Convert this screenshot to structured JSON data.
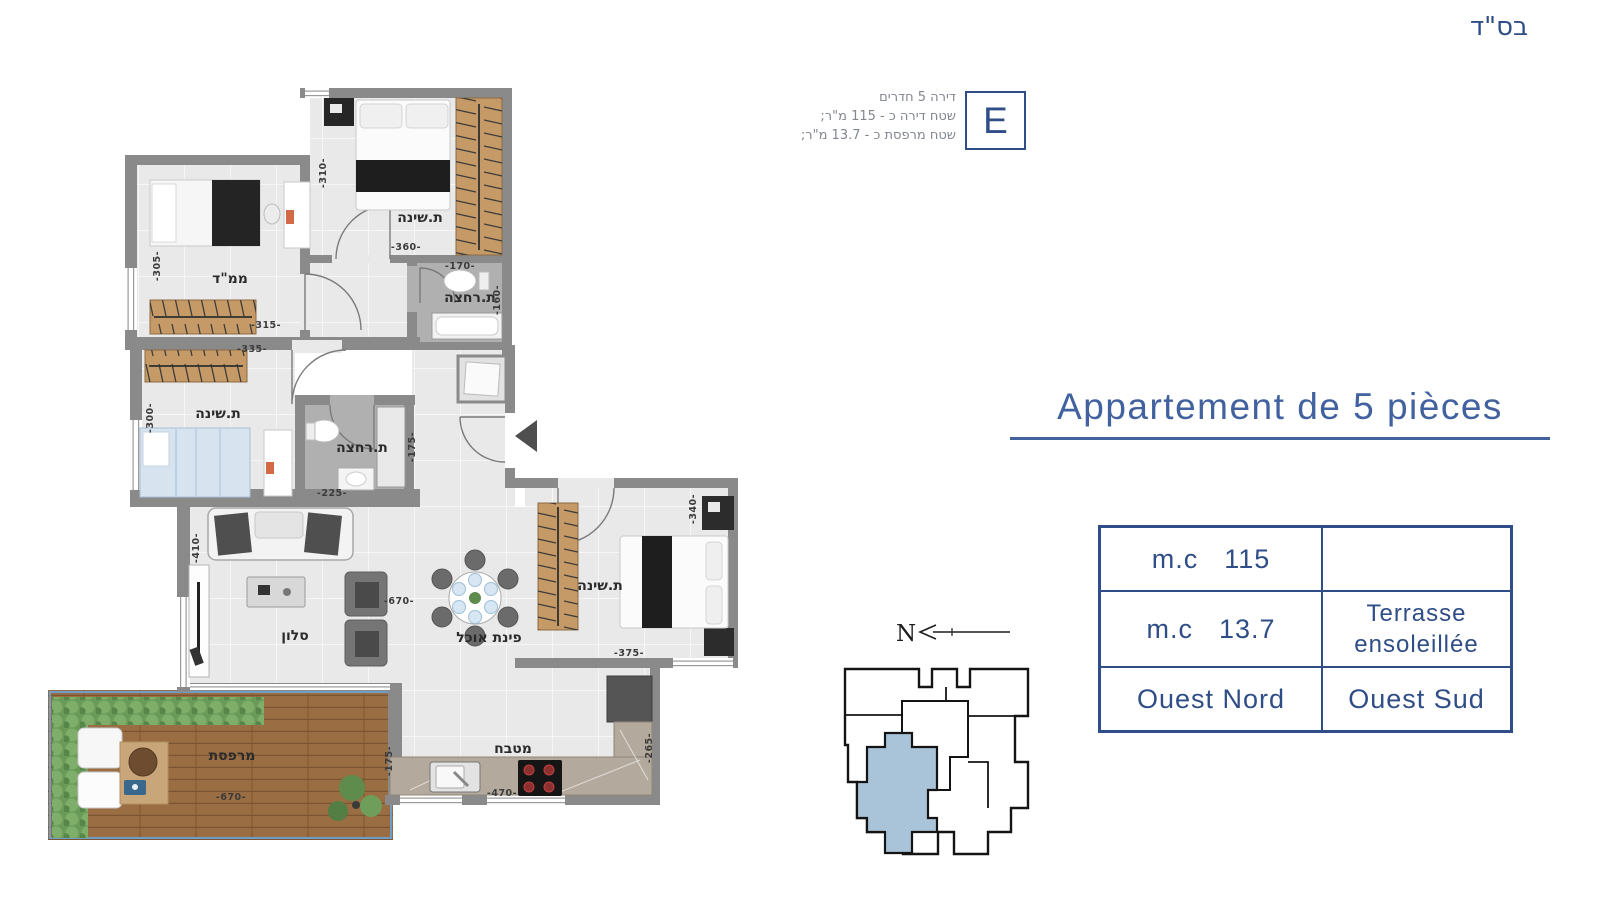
{
  "colors": {
    "accent_blue": "#2f4d86",
    "title_blue": "#41629f",
    "wall_gray": "#8a8a8a",
    "floor_gray": "#e9e9e9",
    "bath_gray": "#b0b0b0",
    "wood": "#c59a66",
    "deck_wood": "#9a6d42",
    "hedge_green": "#6a9a58",
    "unit_fill_blue": "#a9c3d9"
  },
  "header": {
    "bsd": "בס\"ד",
    "unit_letter": "E",
    "unit_info_lines": [
      "דירה 5 חדרים",
      "שטח דירה כ - 115 מ\"ר;",
      "שטח מרפסת כ - 13.7 מ\"ר;"
    ]
  },
  "right_panel": {
    "title": "Appartement de 5 pièces",
    "compass_label": "N",
    "table": {
      "rows": [
        {
          "unit": "m.c",
          "value": "115",
          "desc": ""
        },
        {
          "unit": "m.c",
          "value": "13.7",
          "desc1": "Terrasse",
          "desc2": "ensoleillée"
        },
        {
          "left": "Ouest Nord",
          "right": "Ouest Sud"
        }
      ]
    }
  },
  "floor_plan": {
    "rooms": [
      {
        "name": "bedroom-top",
        "label": "ת.שינה"
      },
      {
        "name": "mamad",
        "label": "ממ\"ד"
      },
      {
        "name": "bathroom-top",
        "label": "ת.רחצה"
      },
      {
        "name": "bedroom-left",
        "label": "ת.שינה"
      },
      {
        "name": "bathroom-middle",
        "label": "ת.רחצה"
      },
      {
        "name": "living-room",
        "label": "סלון"
      },
      {
        "name": "dining-area",
        "label": "פינת אוכל"
      },
      {
        "name": "bedroom-right",
        "label": "ת.שינה"
      },
      {
        "name": "kitchen",
        "label": "מטבח"
      },
      {
        "name": "terrace",
        "label": "מרפסת"
      }
    ],
    "dimensions": [
      {
        "name": "bedroom-top-height",
        "text": "-310-"
      },
      {
        "name": "bedroom-top-width",
        "text": "-360-"
      },
      {
        "name": "mamad-height",
        "text": "-305-"
      },
      {
        "name": "mamad-width",
        "text": "-315-"
      },
      {
        "name": "bedroom-left-width",
        "text": "-335-"
      },
      {
        "name": "bathroom-top-width",
        "text": "-170-"
      },
      {
        "name": "bathroom-top-height",
        "text": "-160-"
      },
      {
        "name": "bedroom-left-height",
        "text": "-300-"
      },
      {
        "name": "bathroom-mid-width",
        "text": "-225-"
      },
      {
        "name": "bathroom-mid-height",
        "text": "-175-"
      },
      {
        "name": "living-height",
        "text": "-410-"
      },
      {
        "name": "living-width",
        "text": "-670-"
      },
      {
        "name": "bedroom-right-height",
        "text": "-340-"
      },
      {
        "name": "bedroom-right-width",
        "text": "-375-"
      },
      {
        "name": "terrace-height",
        "text": "-175-"
      },
      {
        "name": "kitchen-width",
        "text": "-470-"
      },
      {
        "name": "kitchen-height",
        "text": "-265-"
      },
      {
        "name": "terrace-width",
        "text": "-670-"
      }
    ]
  }
}
